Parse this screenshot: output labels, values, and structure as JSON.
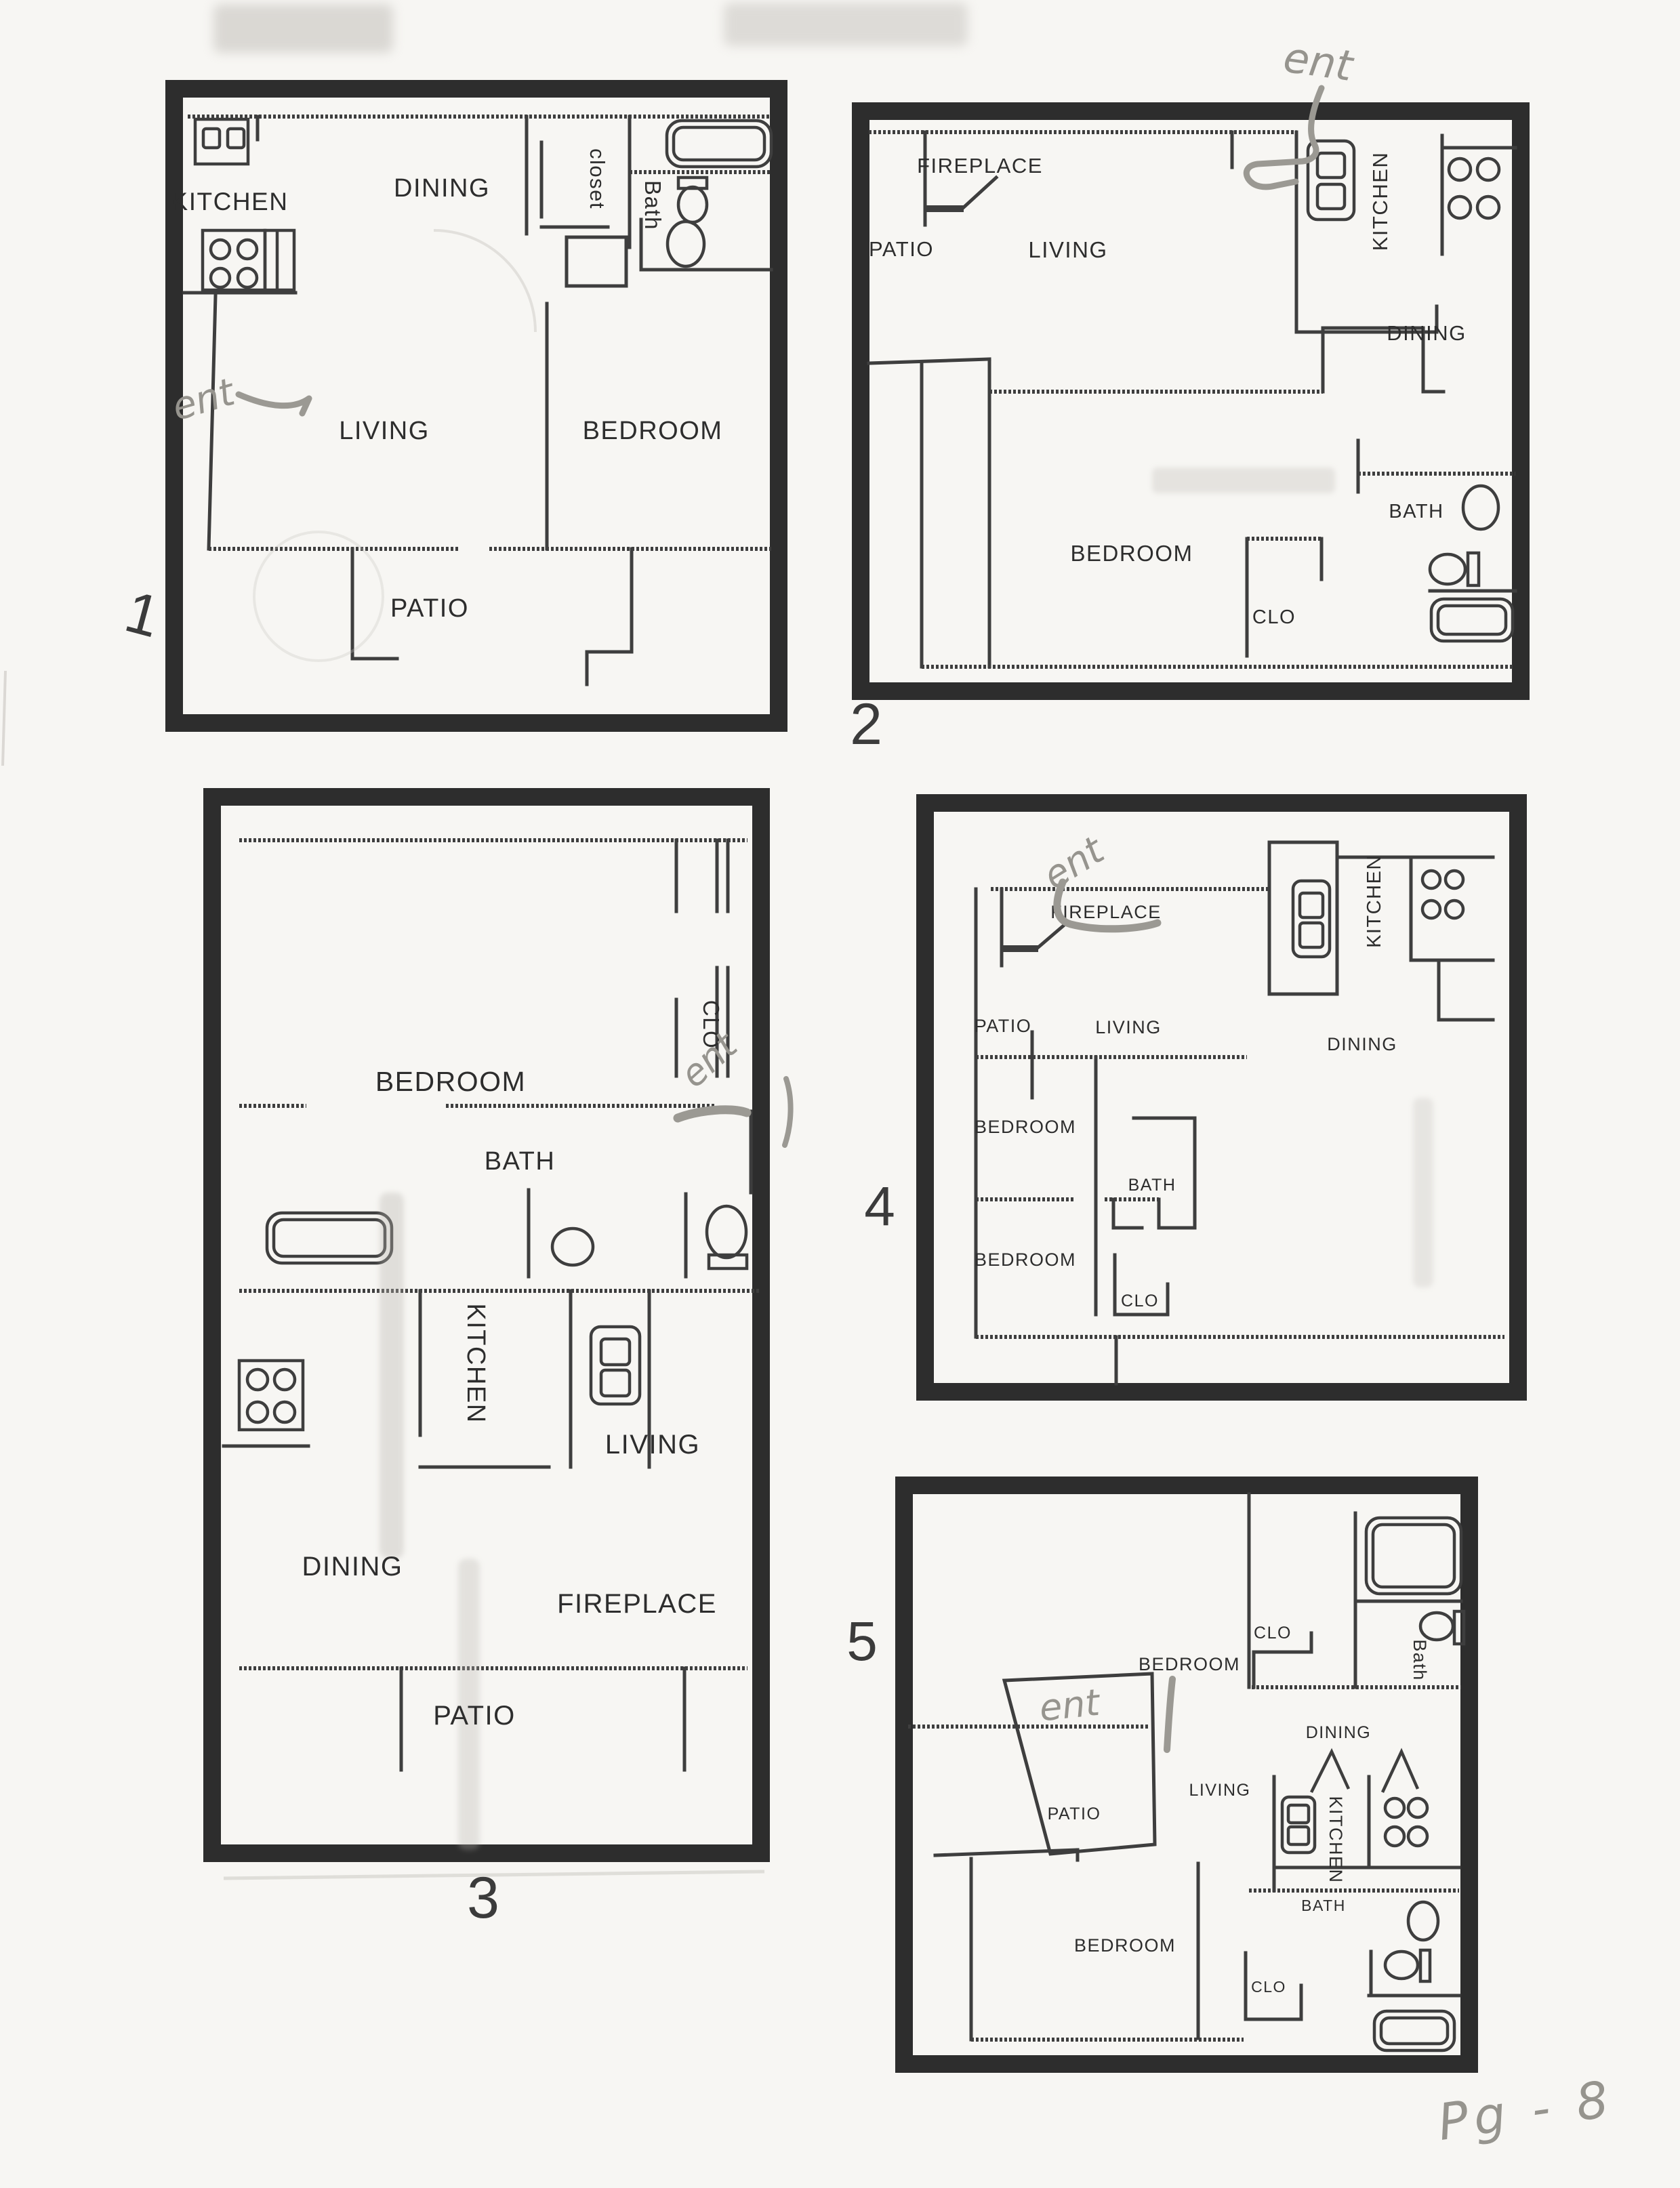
{
  "document": {
    "type": "scanned-floor-plan-sheet",
    "page_note": "Pg - 8",
    "colors": {
      "paper": "#f7f6f3",
      "ink": "#2d2d2d",
      "pencil": "#9b9993"
    }
  },
  "plans": [
    {
      "number": "1",
      "annotation": "ent",
      "rooms": {
        "kitchen": "KITCHEN",
        "dining": "DINING",
        "closet": "closet",
        "bath": "Bath",
        "living": "LIVING",
        "bedroom": "BEDROOM",
        "patio": "PATIO"
      }
    },
    {
      "number": "2",
      "annotation": "ent",
      "rooms": {
        "fireplace": "FIREPLACE",
        "patio": "PATIO",
        "living": "LIVING",
        "kitchen": "KITCHEN",
        "dining": "DINING",
        "bedroom": "BEDROOM",
        "clo": "CLO",
        "bath": "BATH"
      }
    },
    {
      "number": "3",
      "annotation": "ent",
      "rooms": {
        "bedroom": "BEDROOM",
        "clo": "CLO",
        "bath": "BATH",
        "kitchen": "KITCHEN",
        "living": "LIVING",
        "dining": "DINING",
        "fireplace": "FIREPLACE",
        "patio": "PATIO"
      }
    },
    {
      "number": "4",
      "annotation": "ent",
      "rooms": {
        "fireplace": "FIREPLACE",
        "patio": "PATIO",
        "living": "LIVING",
        "kitchen": "KITCHEN",
        "dining": "DINING",
        "bedroom1": "BEDROOM",
        "bath": "BATH",
        "bedroom2": "BEDROOM",
        "clo": "CLO"
      }
    },
    {
      "number": "5",
      "annotation": "ent",
      "rooms": {
        "clo1": "CLO",
        "bath1": "Bath",
        "bedroom1": "BEDROOM",
        "dining": "DINING",
        "patio": "PATIO",
        "living": "LIVING",
        "kitchen": "KITCHEN",
        "bath2": "BATH",
        "bedroom2": "BEDROOM",
        "clo2": "CLO"
      }
    }
  ]
}
